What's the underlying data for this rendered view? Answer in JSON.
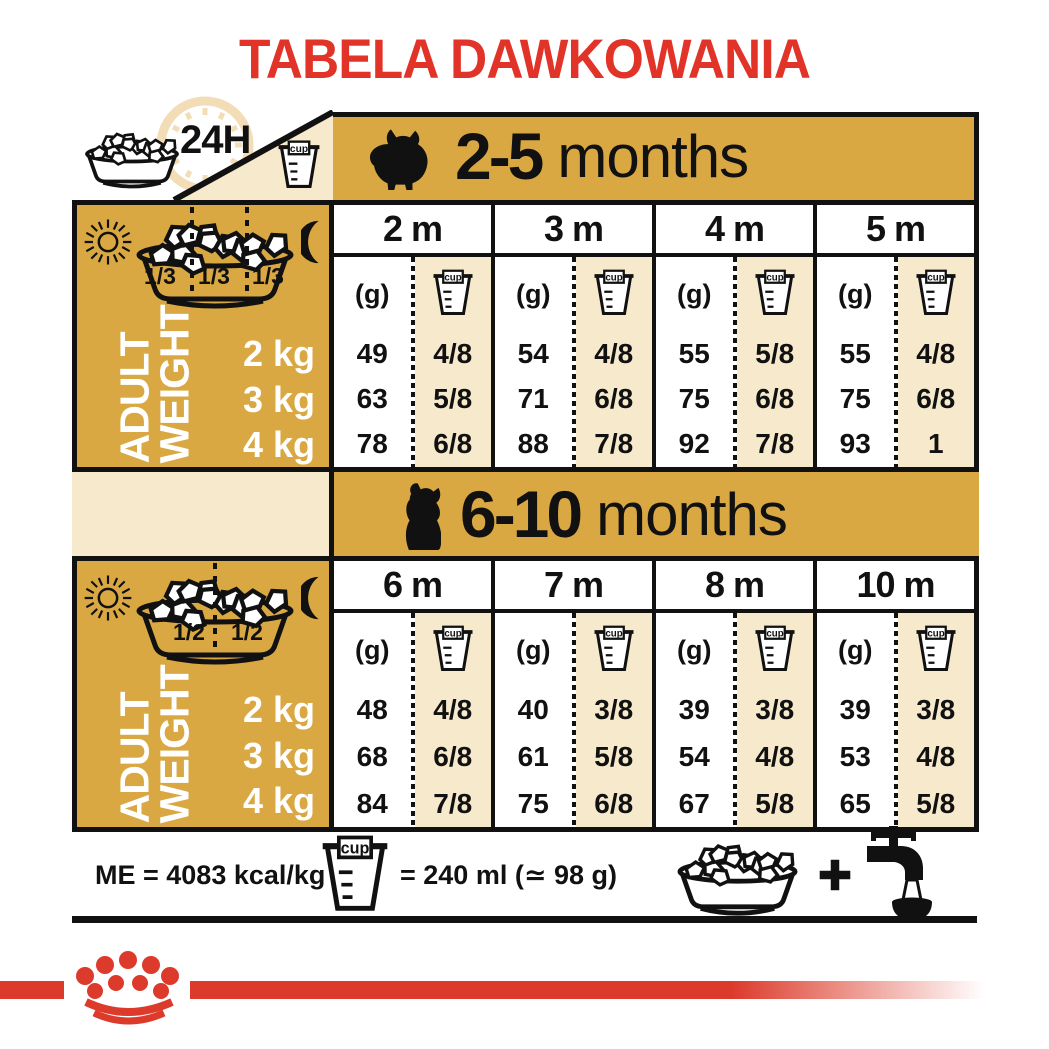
{
  "title": "TABELA DAWKOWANIA",
  "h24": "24H",
  "cup_label": "cup",
  "unit_g": "(g)",
  "colors": {
    "title_red": "#E23329",
    "band_red": "#DC3A2A",
    "gold": "#D9A843",
    "cream": "#F7EACC",
    "ink": "#111111"
  },
  "sections": [
    {
      "age_bold": "2-5",
      "age_rest": "months",
      "fractions": [
        "1/3",
        "1/3",
        "1/3"
      ],
      "side1": "ADULT",
      "side2": "WEIGHT",
      "weights": [
        "2 kg",
        "3 kg",
        "4 kg"
      ],
      "months": [
        {
          "label": "2 m",
          "g": [
            "49",
            "63",
            "78"
          ],
          "cup": [
            "4/8",
            "5/8",
            "6/8"
          ]
        },
        {
          "label": "3 m",
          "g": [
            "54",
            "71",
            "88"
          ],
          "cup": [
            "4/8",
            "6/8",
            "7/8"
          ]
        },
        {
          "label": "4 m",
          "g": [
            "55",
            "75",
            "92"
          ],
          "cup": [
            "5/8",
            "6/8",
            "7/8"
          ]
        },
        {
          "label": "5 m",
          "g": [
            "55",
            "75",
            "93"
          ],
          "cup": [
            "4/8",
            "6/8",
            "1"
          ]
        }
      ]
    },
    {
      "age_bold": "6-10",
      "age_rest": "months",
      "fractions": [
        "1/2",
        "1/2"
      ],
      "side1": "ADULT",
      "side2": "WEIGHT",
      "weights": [
        "2 kg",
        "3 kg",
        "4 kg"
      ],
      "months": [
        {
          "label": "6 m",
          "g": [
            "48",
            "68",
            "84"
          ],
          "cup": [
            "4/8",
            "6/8",
            "7/8"
          ]
        },
        {
          "label": "7 m",
          "g": [
            "40",
            "61",
            "75"
          ],
          "cup": [
            "3/8",
            "5/8",
            "6/8"
          ]
        },
        {
          "label": "8 m",
          "g": [
            "39",
            "54",
            "67"
          ],
          "cup": [
            "3/8",
            "4/8",
            "5/8"
          ]
        },
        {
          "label": "10 m",
          "g": [
            "39",
            "53",
            "65"
          ],
          "cup": [
            "3/8",
            "4/8",
            "5/8"
          ]
        }
      ]
    }
  ],
  "footer": {
    "me_label": "ME = 4083 kcal/kg",
    "cup_equiv": "= 240 ml (≃ 98 g)"
  }
}
